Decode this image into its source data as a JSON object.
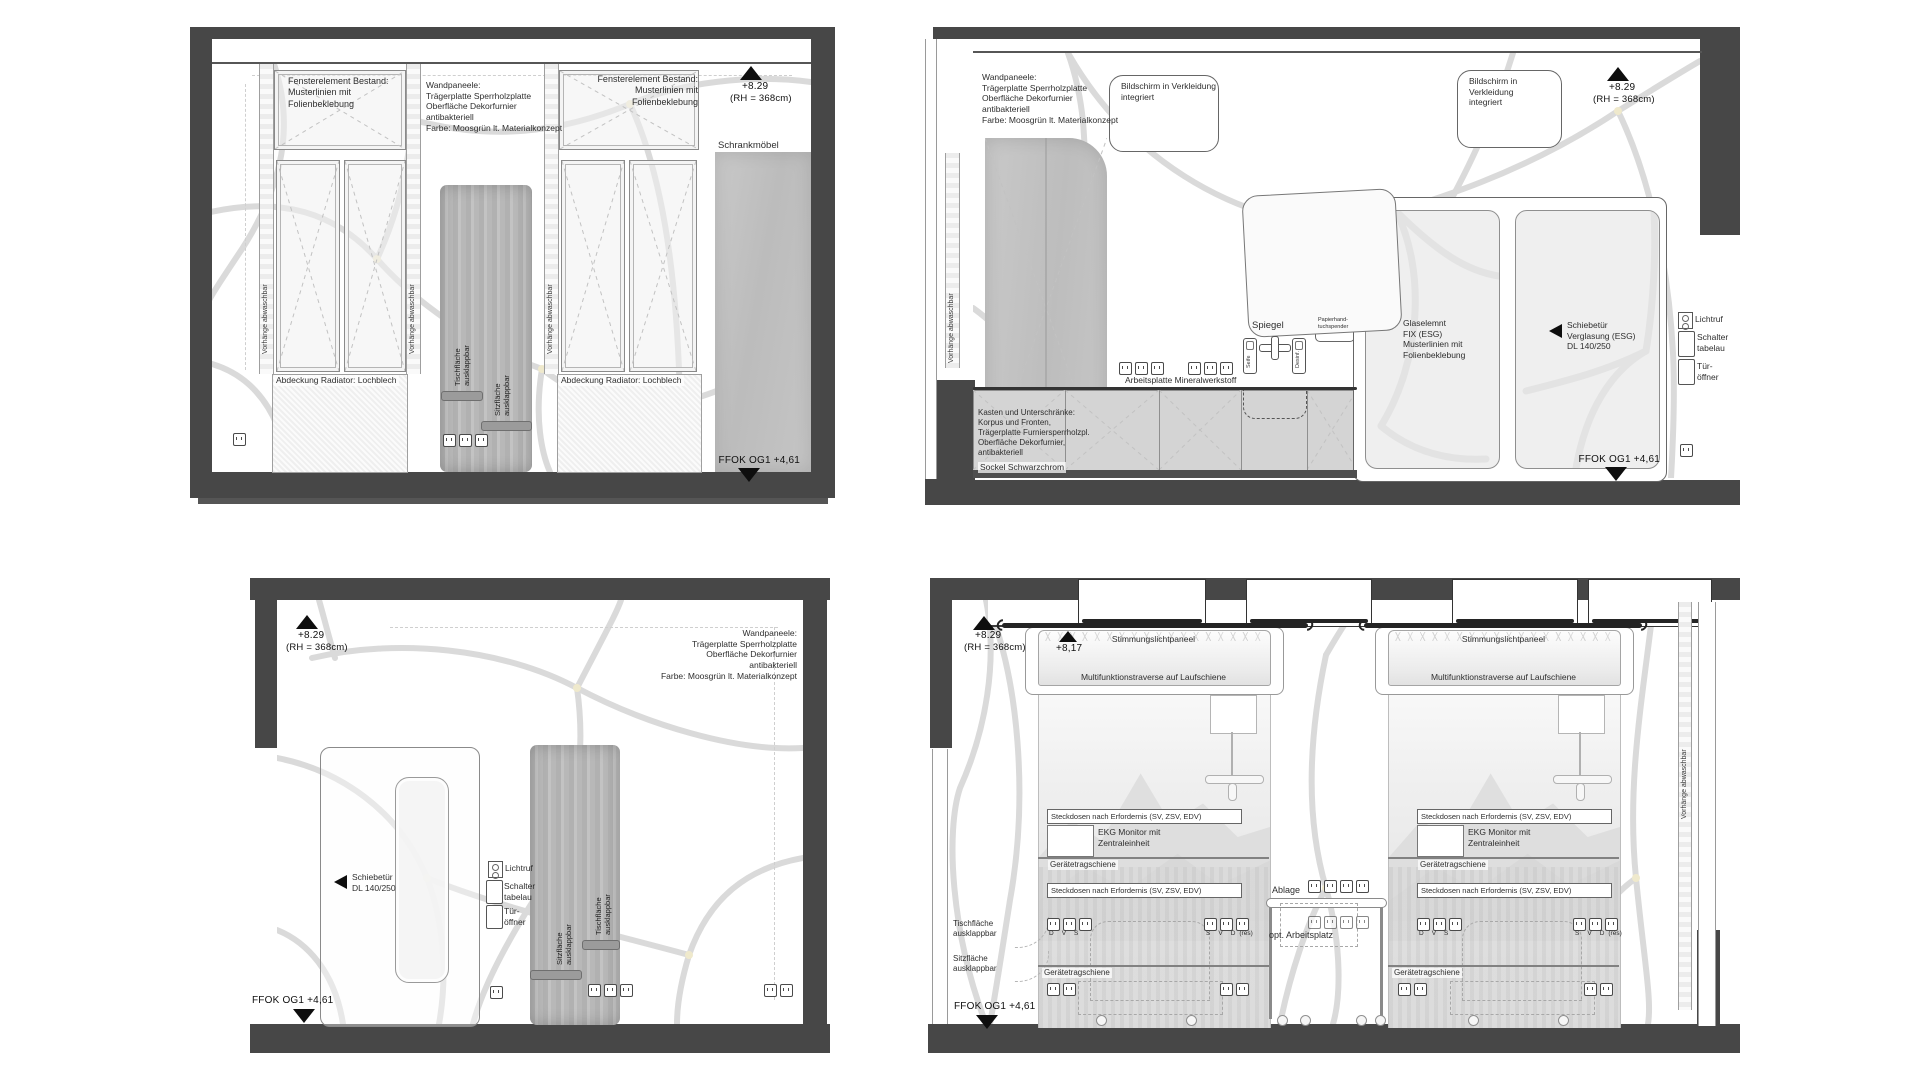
{
  "sheet": {
    "background": "#ffffff",
    "wall_color": "#474747",
    "pattern_color": "#dadada",
    "junction_dot_color": "#efe9cc"
  },
  "common": {
    "curtain": "Vorhänge abwaschbar",
    "wandpaneele": "Wandpaneele:\nTrägerplatte Sperrholzplatte\nOberfläche Dekorfurnier\nantibakteriell\nFarbe: Moosgrün lt. Materialkonzept",
    "level_top": "+8.29",
    "level_rh": "(RH = 368cm)",
    "level_ffok": "FFOK OG1 +4,61",
    "lichtruf": "Lichtruf",
    "schalter": "Schalter\ntabelau",
    "tueroeffner": "Tür-\nöffner",
    "tischflaeche": "Tischfläche\nausklappbar",
    "sitzflaeche": "Sitzfläche\nausklappbar"
  },
  "panel1": {
    "fenster": "Fensterelement Bestand:\nMusterlinien mit\nFolienbeklebung",
    "radiator": "Abdeckung Radiator: Lochblech",
    "schrank": "Schrankmöbel"
  },
  "panel2": {
    "bildschirm": "Bildschirm in Verkleidung\nintegriert",
    "spiegel": "Spiegel",
    "papier": "Papierhand-\ntuchspender",
    "seife": "Seife",
    "desinf": "Desinf.",
    "arbeitsplatte": "Arbeitsplatte Mineralwerkstoff",
    "kasten": "Kasten und Unterschränke:\nKorpus und Fronten,\nTrägerplatte Furniersperrholzpl.\nOberfläche Dekorfurnier,\nantibakteriell",
    "sockel": "Sockel Schwarzchrom",
    "glas": "Glaselemnt\nFIX (ESG)\nMusterlinien mit\nFolienbeklebung",
    "schiebetuer": "Schiebetür\nVerglasung (ESG)\nDL 140/250"
  },
  "panel3": {
    "schiebetuer": "Schiebetür\nDL 140/250"
  },
  "panel4": {
    "stimmung": "Stimmungslichtpaneel",
    "traverse": "Multifunktionstraverse auf Laufschiene",
    "level_817": "+8,17",
    "steckdosen": "Steckdosen nach Erfordernis (SV, ZSV, EDV)",
    "ekg": "EKG Monitor mit\nZentraleinheit",
    "geraetetragschiene": "Gerätetragschiene",
    "ablage": "Ablage",
    "arbeitsplatz": "opt. Arbeitsplatz",
    "socket_letters_left": [
      "D",
      "V",
      "S"
    ],
    "socket_letters_right": [
      "S",
      "V",
      "D"
    ],
    "res": "(res)"
  }
}
